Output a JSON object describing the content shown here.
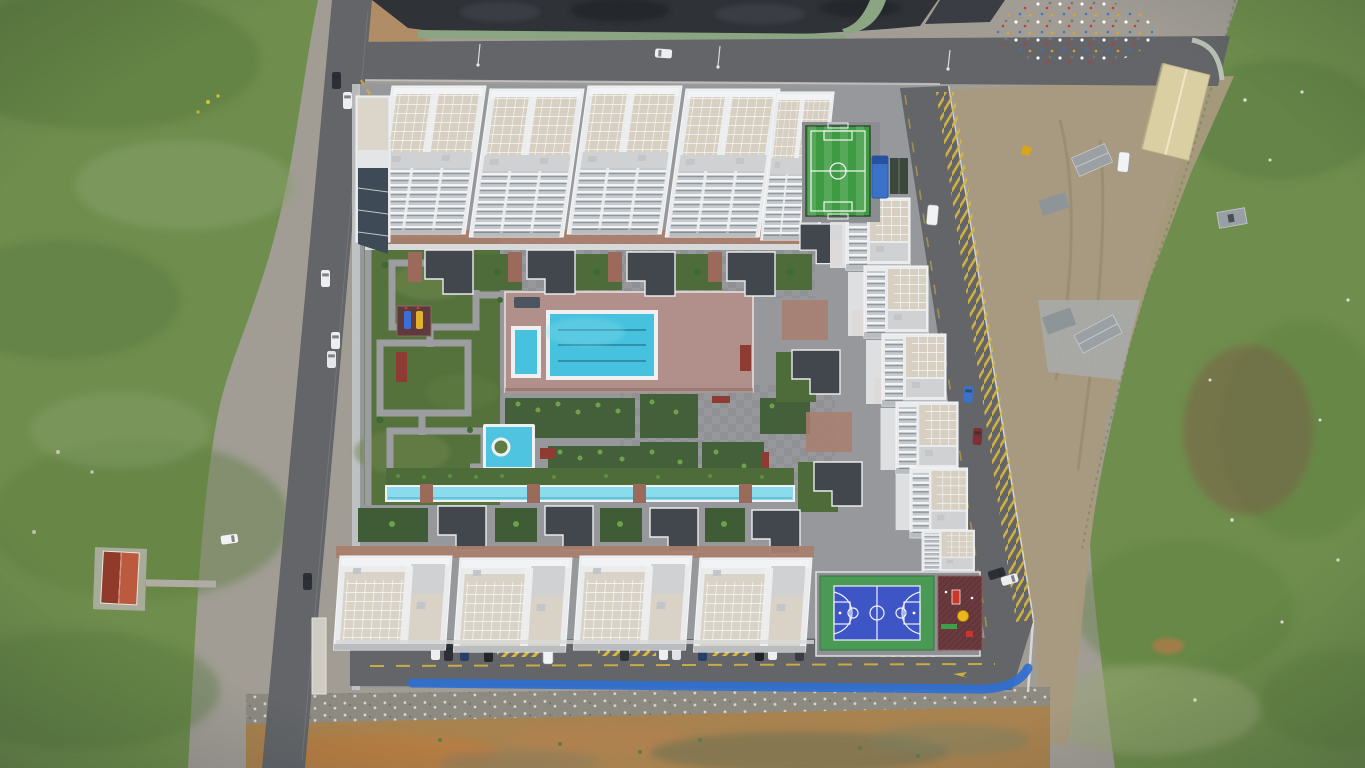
{
  "scene": {
    "type": "aerial-drone-photograph",
    "subject": "Top-down drone view of a white residential apartment complex with a central swimming pool, landscaped maze gardens, a water canal, a mini football pitch, a basketball court and playgrounds, ringed by a perimeter parking road; surrounded by waste ground, gravel, a dark stockpile, roads and green fields",
    "camera": "nadir (straight down)",
    "colors": {
      "gravel": "#a19d95",
      "grass": "#6f8e4d",
      "grass_dark": "#597a3e",
      "dirt_tan": "#a89a7e",
      "dirt_orange": "#a8824f",
      "charcoal_pile": "#2f3338",
      "wall_green": "#8ba583",
      "asphalt": "#636568",
      "complex_paving": "#96989b",
      "building_white": "#eaebec",
      "roof_beige": "#d6cfc2",
      "roof_dark": "#42474d",
      "terrace_brick": "#a87e6e",
      "pool_deck": "#b18f8a",
      "pool_water": "#47c2de",
      "canal_water": "#8adcec",
      "pond_water": "#4ec4e0",
      "soccer_green": "#3f9b43",
      "court_blue": "#3d55c5",
      "court_green": "#4a9a55",
      "playground_red": "#6b3a3e",
      "marking_yellow": "#d9b73e",
      "blue_strip": "#2f6fd0",
      "warehouse_beige": "#d9cfa3",
      "house_roof_red": "#bc5a40",
      "truck_blue": "#3a72c8"
    },
    "features": {
      "apartment_towers_top_row": 5,
      "apartment_blocks_right_wing": 6,
      "apartment_blocks_bottom_row": 4,
      "swimming_pool_lane_lines": 3,
      "kids_pool": 1,
      "ornamental_pond": 1,
      "water_canal": 1,
      "mini_football_pitch": 1,
      "basketball_court": 1,
      "playgrounds": 2,
      "coal_stockpile": 1,
      "warehouse": 1,
      "red_roof_cottage": 1,
      "parked_cars_visible": 25
    }
  }
}
